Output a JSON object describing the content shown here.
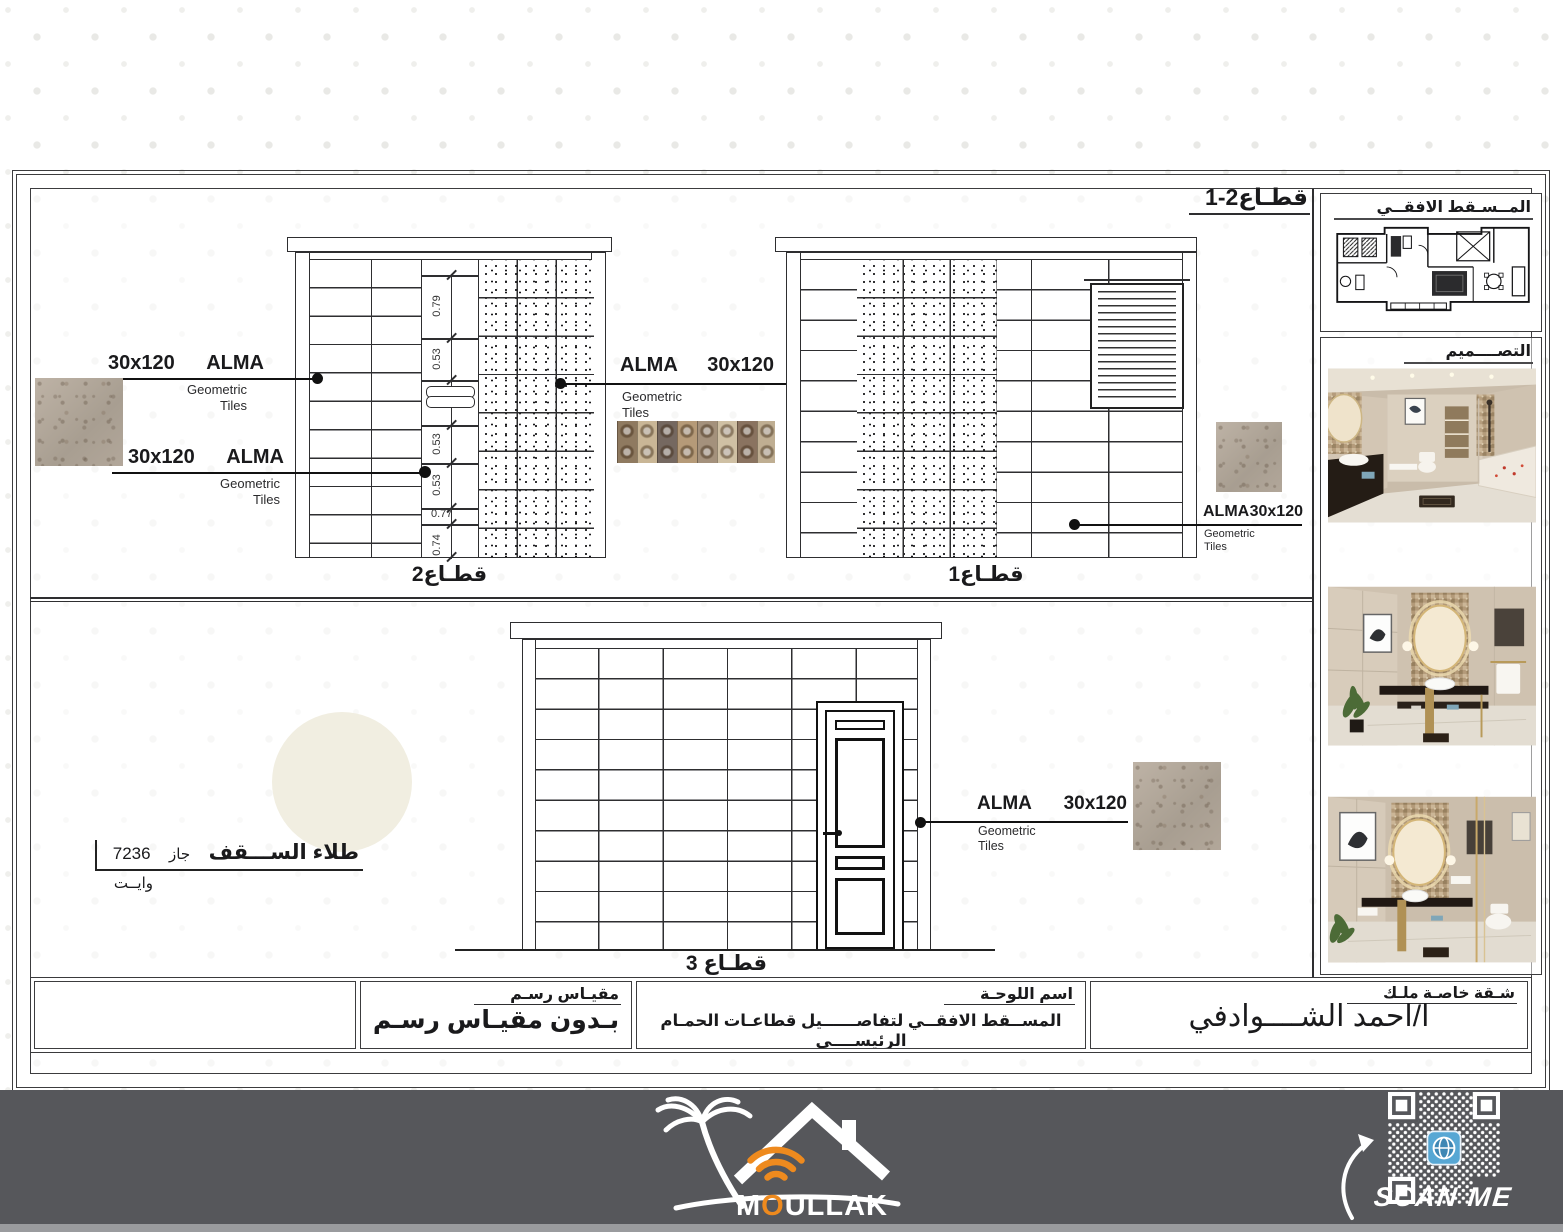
{
  "frame": {
    "section_ref": "قطـاع2-1"
  },
  "sidebar": {
    "plan_title": "المــسـقط الافقــي",
    "design_title": "التصــــميم"
  },
  "sections": {
    "s1_label": "قطـاع1",
    "s2_label": "قطـاع2",
    "s3_label": "قطـاع 3"
  },
  "dims": {
    "d1": "0.79",
    "d2": "0.53",
    "d3": "0.53",
    "d4": "0.53",
    "d5": "0.77",
    "d6": "0.74"
  },
  "callout": {
    "brand": "ALMA",
    "size": "30x120",
    "sub1": "Geometric",
    "sub2": "Tiles"
  },
  "ceiling_note": {
    "title": "طلاء الســـقف",
    "word": "جاز",
    "code": "7236",
    "line2": "وايــت"
  },
  "title_block": {
    "scale_label": "مقيـاس رسـم",
    "scale_value": "بـدون مقيـاس رسـم",
    "sheet_label": "اسم اللوحـة",
    "sheet_value": "المســقط الافقــي لتفاصــــــيل قطاعـات الحمـام الرئيســــي",
    "owner_label": "شـقة خاصـة ملـك",
    "owner_value": "ا/احمد الشــــوادفي"
  },
  "footer": {
    "brand_m": "M",
    "brand_o": "O",
    "brand_rest": "ULLAK",
    "scan_label": "SCAN ME"
  },
  "colors": {
    "accent_orange": "#EE8A1E",
    "footer_gray": "#56575B"
  }
}
